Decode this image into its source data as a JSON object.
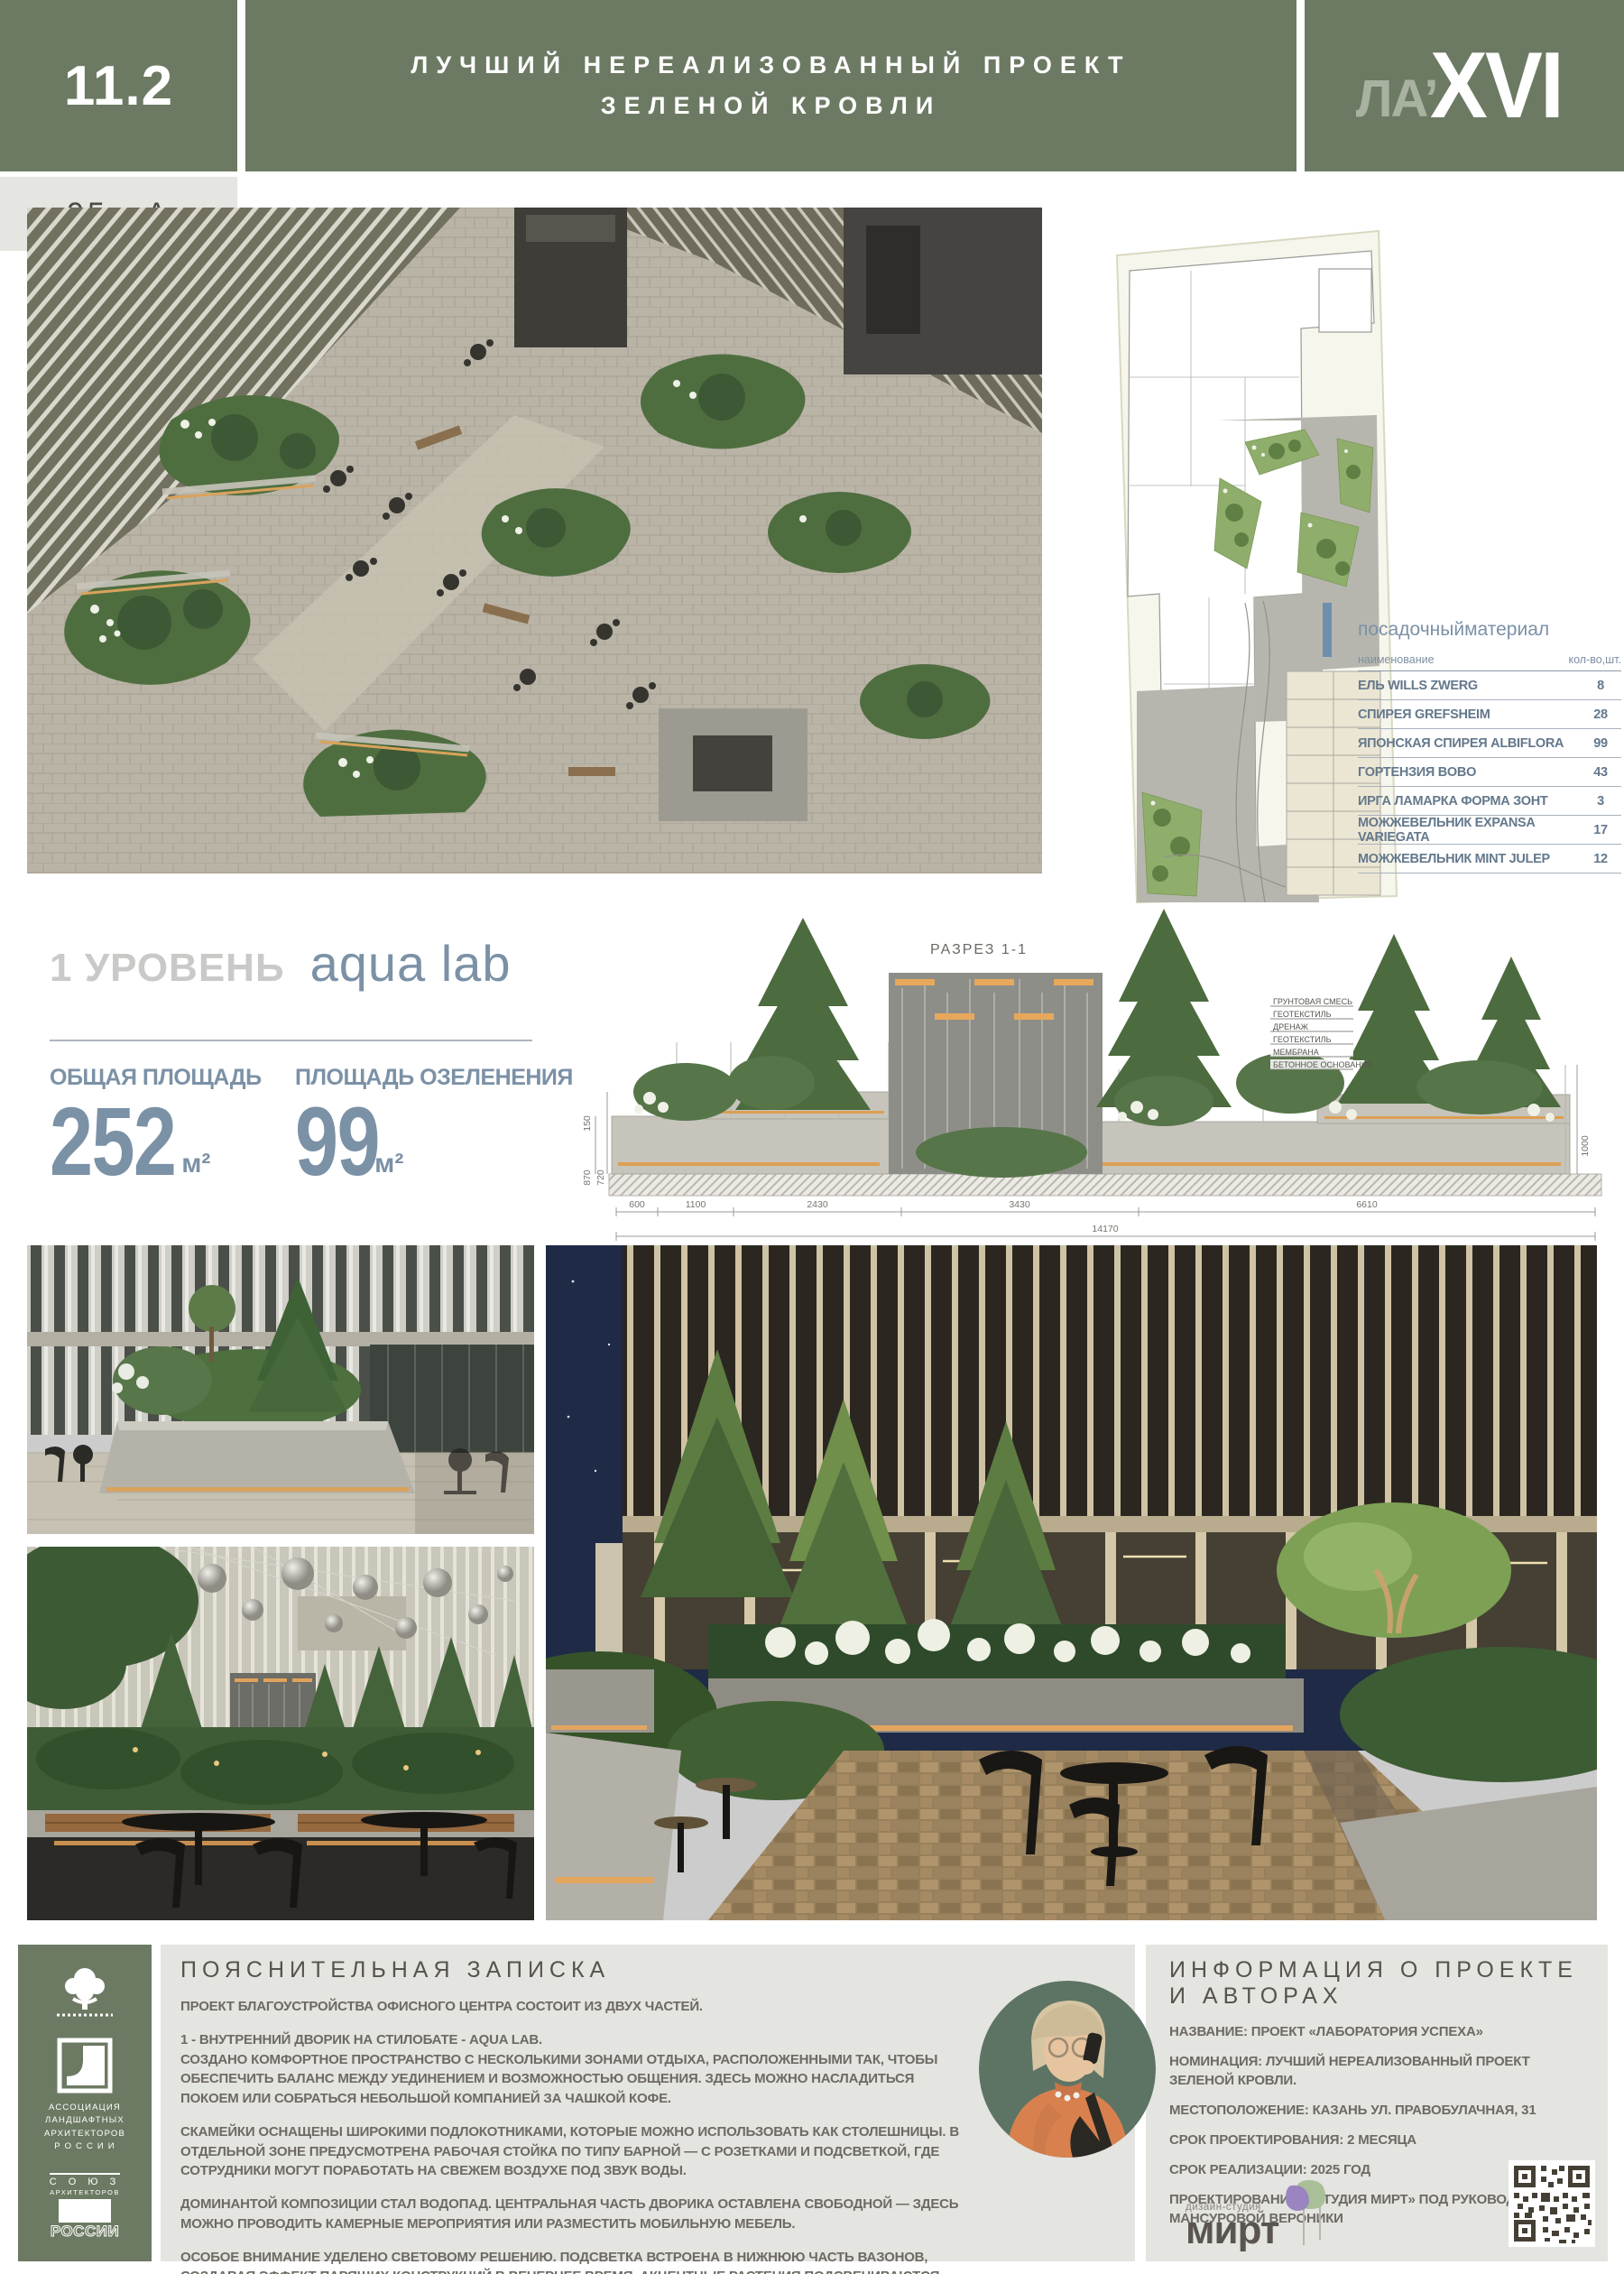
{
  "colors": {
    "header_green": "#6d7a63",
    "accent_blue": "#7b91a6",
    "table_text_blue": "#64788c",
    "panel_gray": "#e4e4e1",
    "heading_dark": "#56534d",
    "body_text": "#6e6a63",
    "leaf_purple": "#9a85c0",
    "leaf_green": "#a9bf97",
    "avatar_bg": "#5d7464"
  },
  "header": {
    "index": "11.2",
    "title_line1": "ЛУЧШИЙ НЕРЕАЛИЗОВАННЫЙ ПРОЕКТ",
    "title_line2": "ЗЕЛЕНОЙ КРОВЛИ",
    "logo_prefix": "ЛА’",
    "logo_suffix": "XVI"
  },
  "board_code": "95 - А",
  "level": {
    "label": "1 УРОВЕНЬ",
    "name": "aqua lab",
    "stats": [
      {
        "label": "ОБЩАЯ ПЛОЩАДЬ",
        "value": "252",
        "unit": "м²"
      },
      {
        "label": "ПЛОЩАДЬ ОЗЕЛЕНЕНИЯ",
        "value": "99",
        "unit": "м²"
      }
    ]
  },
  "plant_table": {
    "title": "посадочныйматериал",
    "col_name": "наименование",
    "col_qty": "кол-во,шт.",
    "rows": [
      {
        "name": "ЕЛЬ WILLS ZWERG",
        "qty": "8"
      },
      {
        "name": "СПИРЕЯ GREFSHEIM",
        "qty": "28"
      },
      {
        "name": "ЯПОНСКАЯ СПИРЕЯ ALBIFLORA",
        "qty": "99"
      },
      {
        "name": "ГОРТЕНЗИЯ BOBO",
        "qty": "43"
      },
      {
        "name": "ИРГА ЛАМАРКА ФОРМА ЗОНТ",
        "qty": "3"
      },
      {
        "name": "МОЖЖЕВЕЛЬНИК EXPANSA VARIEGATA",
        "qty": "17"
      },
      {
        "name": "МОЖЖЕВЕЛЬНИК MINT JULEP",
        "qty": "12"
      }
    ]
  },
  "section_drawing": {
    "title": "РАЗРЕЗ 1-1",
    "materials": [
      "ГРУНТОВАЯ СМЕСЬ",
      "ГЕОТЕКСТИЛЬ",
      "ДРЕНАЖ",
      "ГЕОТЕКСТИЛЬ",
      "МЕМБРАНА",
      "БЕТОННОЕ ОСНОВАНИЕ"
    ],
    "dims_bottom": [
      "600",
      "1100",
      "2430",
      "3430",
      "6610"
    ],
    "dim_total": "14170",
    "dims_left": [
      "150",
      "870",
      "720"
    ],
    "dim_right": "1000"
  },
  "note": {
    "heading": "ПОЯСНИТЕЛЬНАЯ ЗАПИСКА",
    "paragraphs": [
      "ПРОЕКТ БЛАГОУСТРОЙСТВА ОФИСНОГО ЦЕНТРА СОСТОИТ ИЗ ДВУХ ЧАСТЕЙ.",
      "1 - ВНУТРЕННИЙ ДВОРИК НА СТИЛОБАТЕ - AQUA LAB.\nСОЗДАНО КОМФОРТНОЕ ПРОСТРАНСТВО С НЕСКОЛЬКИМИ ЗОНАМИ ОТДЫХА, РАСПОЛОЖЕННЫМИ ТАК, ЧТОБЫ ОБЕСПЕЧИТЬ БАЛАНС МЕЖДУ УЕДИНЕНИЕМ И ВОЗМОЖНОСТЬЮ ОБЩЕНИЯ. ЗДЕСЬ МОЖНО НАСЛАДИТЬСЯ ПОКОЕМ ИЛИ СОБРАТЬСЯ НЕБОЛЬШОЙ КОМПАНИЕЙ ЗА ЧАШКОЙ КОФЕ.",
      "СКАМЕЙКИ ОСНАЩЕНЫ ШИРОКИМИ ПОДЛОКОТНИКАМИ, КОТОРЫЕ МОЖНО ИСПОЛЬЗОВАТЬ КАК СТОЛЕШНИЦЫ. В ОТДЕЛЬНОЙ ЗОНЕ ПРЕДУСМОТРЕНА РАБОЧАЯ СТОЙКА ПО ТИПУ БАРНОЙ — С РОЗЕТКАМИ И ПОДСВЕТКОЙ, ГДЕ СОТРУДНИКИ МОГУТ ПОРАБОТАТЬ НА СВЕЖЕМ ВОЗДУХЕ ПОД ЗВУК ВОДЫ.",
      "ДОМИНАНТОЙ КОМПОЗИЦИИ СТАЛ ВОДОПАД. ЦЕНТРАЛЬНАЯ ЧАСТЬ ДВОРИКА ОСТАВЛЕНА СВОБОДНОЙ — ЗДЕСЬ МОЖНО ПРОВОДИТЬ КАМЕРНЫЕ МЕРОПРИЯТИЯ ИЛИ РАЗМЕСТИТЬ МОБИЛЬНУЮ МЕБЕЛЬ.",
      "ОСОБОЕ ВНИМАНИЕ УДЕЛЕНО СВЕТОВОМУ РЕШЕНИЮ. ПОДСВЕТКА ВСТРОЕНА В НИЖНЮЮ ЧАСТЬ ВАЗОНОВ, СОЗДАВАЯ ЭФФЕКТ ПАРЯЩИХ КОНСТРУКЦИЙ В ВЕЧЕРНЕЕ ВРЕМЯ. АКЦЕНТНЫЕ РАСТЕНИЯ ПОДСВЕЧИВАЮТСЯ ПРОЖЕКТОРАМИ SCORE, А ГРУППЫ КУСТАРНИКОВ — СВЕТИЛЬНИКАМИ SPEAR."
    ]
  },
  "info": {
    "heading": "ИНФОРМАЦИЯ О ПРОЕКТЕ И АВТОРАХ",
    "lines": [
      "НАЗВАНИЕ: ПРОЕКТ «ЛАБОРАТОРИЯ УСПЕХА»",
      "НОМИНАЦИЯ: ЛУЧШИЙ НЕРЕАЛИЗОВАННЫЙ ПРОЕКТ ЗЕЛЕНОЙ КРОВЛИ.",
      "МЕСТОПОЛОЖЕНИЕ: КАЗАНЬ УЛ. ПРАВОБУЛАЧНАЯ, 31",
      "СРОК ПРОЕКТИРОВАНИЯ: 2 МЕСЯЦА",
      "СРОК РЕАЛИЗАЦИИ: 2025 ГОД",
      "ПРОЕКТИРОВАНИЕ: «СТУДИЯ МИРТ» ПОД РУКОВОДСТВОМ МАНСУРОВОЙ ВЕРОНИКИ"
    ]
  },
  "studio": {
    "type_label": "дизайн-студия",
    "name": "мирт"
  },
  "logos": {
    "association_lines": [
      "АССОЦИАЦИЯ",
      "ЛАНДШАФТНЫХ",
      "АРХИТЕКТОРОВ",
      "Р О С С И И"
    ],
    "union_top": "С О Ю З",
    "union_mid": "АРХИТЕКТОРОВ",
    "union_bottom": "РОССИИ"
  }
}
